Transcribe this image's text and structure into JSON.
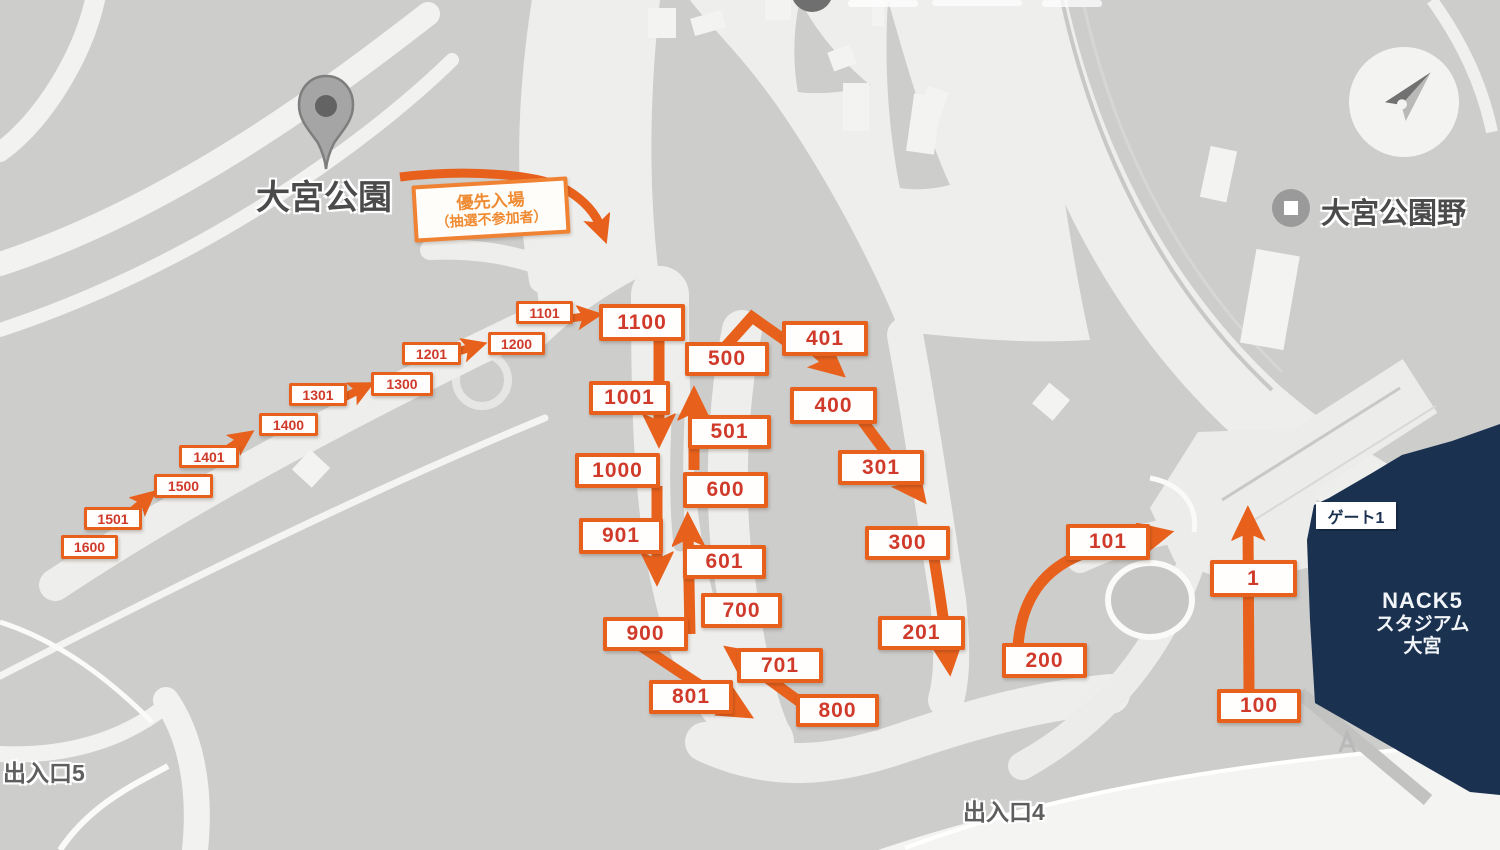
{
  "map": {
    "park_label": "大宮公園",
    "baseball_label": "大宮公園野",
    "exit5_label": "出入口5",
    "exit4_label": "出入口4",
    "priority": {
      "line1": "優先入場",
      "line2": "（抽選不参加者）"
    },
    "gate_label": "ゲート1",
    "stadium": {
      "line1": "NACK5",
      "line2": "スタジアム",
      "line3": "大宮"
    },
    "icons": [
      "map-pin-icon",
      "compass-icon",
      "baseball-venue-icon",
      "top-marker-icon"
    ],
    "colors": {
      "route_orange": "#e8611c",
      "number_red": "#d03a2a",
      "priority_orange": "#ef8b33",
      "stadium_navy": "#1b3150",
      "map_gray": "#cdcdcc",
      "road_light": "#efefed"
    }
  },
  "queue": {
    "boxes": [
      {
        "label": "1"
      },
      {
        "label": "100"
      },
      {
        "label": "101"
      },
      {
        "label": "200"
      },
      {
        "label": "201"
      },
      {
        "label": "300"
      },
      {
        "label": "301"
      },
      {
        "label": "400"
      },
      {
        "label": "401"
      },
      {
        "label": "500"
      },
      {
        "label": "501"
      },
      {
        "label": "600"
      },
      {
        "label": "601"
      },
      {
        "label": "700"
      },
      {
        "label": "701"
      },
      {
        "label": "800"
      },
      {
        "label": "801"
      },
      {
        "label": "900"
      },
      {
        "label": "901"
      },
      {
        "label": "1000"
      },
      {
        "label": "1001"
      },
      {
        "label": "1100"
      },
      {
        "label": "1101"
      },
      {
        "label": "1200"
      },
      {
        "label": "1201"
      },
      {
        "label": "1300"
      },
      {
        "label": "1301"
      },
      {
        "label": "1400"
      },
      {
        "label": "1401"
      },
      {
        "label": "1500"
      },
      {
        "label": "1501"
      },
      {
        "label": "1600"
      }
    ]
  }
}
